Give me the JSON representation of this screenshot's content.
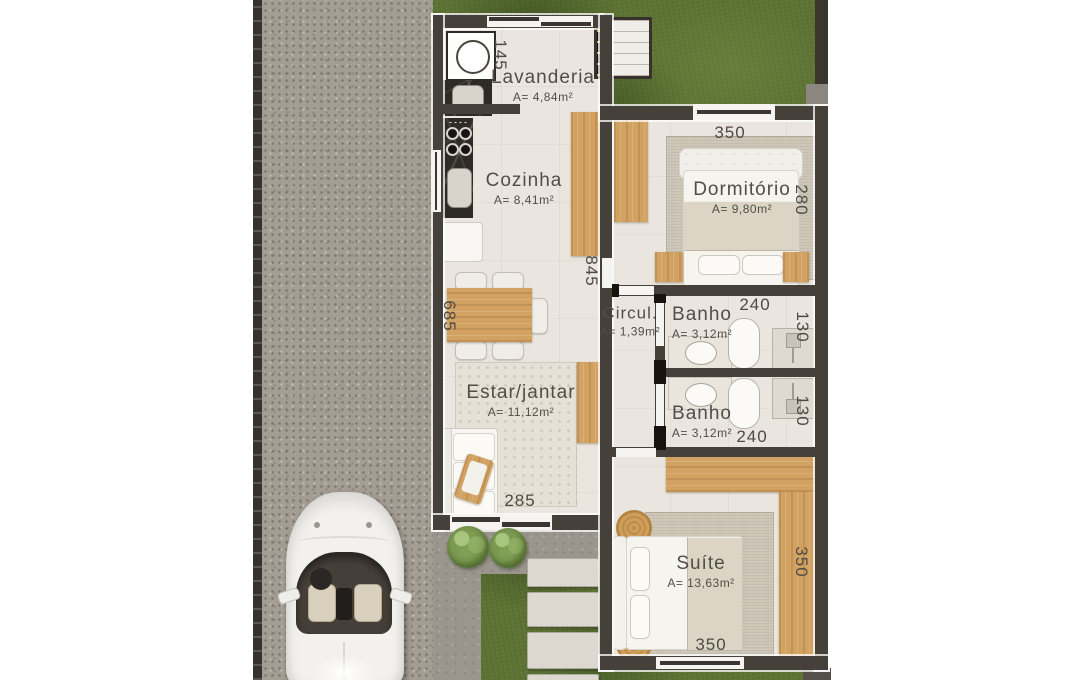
{
  "plan": {
    "rooms": {
      "lavanderia": {
        "name": "Lavanderia",
        "area": "A= 4,84m²"
      },
      "cozinha": {
        "name": "Cozinha",
        "area": "A= 8,41m²"
      },
      "dormitorio": {
        "name": "Dormitório",
        "area": "A= 9,80m²"
      },
      "circulacao": {
        "name": "Circul.",
        "area": "A= 1,39m²"
      },
      "banho_superior": {
        "name": "Banho",
        "area": "A= 3,12m²"
      },
      "banho_inferior": {
        "name": "Banho",
        "area": "A= 3,12m²"
      },
      "estar_jantar": {
        "name": "Estar/jantar",
        "area": "A= 11,12m²"
      },
      "suite": {
        "name": "Suíte",
        "area": "A= 13,63m²"
      }
    },
    "dimensions_cm": {
      "lavanderia_height": "145",
      "cozinha_estar_depth": "845",
      "mesa_jantar": "685",
      "dormitorio_width": "350",
      "dormitorio_depth": "280",
      "banho_superior_width": "240",
      "banho_superior_depth": "130",
      "banho_inferior_depth": "130",
      "banho_inferior_width": "240",
      "estar_frente": "285",
      "suite_depth": "350",
      "suite_width": "350"
    },
    "colors": {
      "wall": "#46403a",
      "floor": "#eae6df",
      "wood": "#d2a263",
      "grass": "#5d7434",
      "driveway": "#a39d93",
      "label_text": "#4f4a43"
    }
  }
}
